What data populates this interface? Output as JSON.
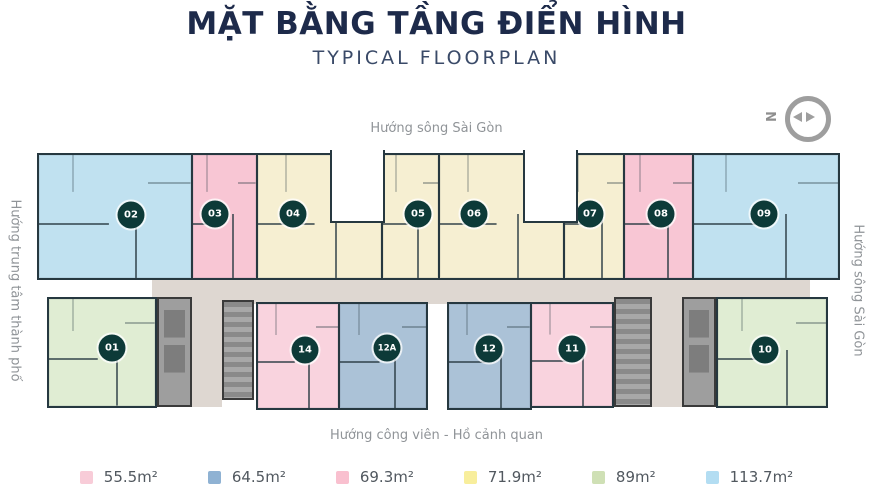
{
  "header": {
    "title": "MẶT BẰNG TẦNG ĐIỂN HÌNH",
    "subtitle": "TYPICAL FLOORPLAN"
  },
  "compass": {
    "north_label": "N"
  },
  "directions": {
    "top": "Hướng sông Sài Gòn",
    "left": "Hướng trung tâm thành phố",
    "right": "Hướng sông Sài Gòn",
    "bottom": "Hướng công viên - Hồ cảnh quan"
  },
  "plan": {
    "units": [
      {
        "id": "02",
        "color": "#c0e1f0",
        "area": "113.7m²"
      },
      {
        "id": "03",
        "color": "#f8c6d4",
        "area": "69.3m²"
      },
      {
        "id": "04",
        "color": "#f6efd2",
        "area": "71.9m²"
      },
      {
        "id": "05",
        "color": "#f6efd2",
        "area": "71.9m²"
      },
      {
        "id": "06",
        "color": "#f6efd2",
        "area": "71.9m²"
      },
      {
        "id": "07",
        "color": "#f6efd2",
        "area": "71.9m²"
      },
      {
        "id": "08",
        "color": "#f8c6d4",
        "area": "69.3m²"
      },
      {
        "id": "09",
        "color": "#c0e1f0",
        "area": "113.7m²"
      },
      {
        "id": "01",
        "color": "#e0edd3",
        "area": "89m²"
      },
      {
        "id": "14",
        "color": "#f9d3de",
        "area": "55.5m²"
      },
      {
        "id": "12A",
        "color": "#abc2d7",
        "area": "64.5m²"
      },
      {
        "id": "12",
        "color": "#abc2d7",
        "area": "64.5m²"
      },
      {
        "id": "11",
        "color": "#f9d3de",
        "area": "55.5m²"
      },
      {
        "id": "10",
        "color": "#e0edd3",
        "area": "89m²"
      }
    ]
  },
  "legend": {
    "items": [
      {
        "label": "55.5m²",
        "color": "#f8ccd8"
      },
      {
        "label": "64.5m²",
        "color": "#8fb2d3"
      },
      {
        "label": "69.3m²",
        "color": "#f9c0cf"
      },
      {
        "label": "71.9m²",
        "color": "#f8ee9c"
      },
      {
        "label": "89m²",
        "color": "#cfe0b5"
      },
      {
        "label": "113.7m²",
        "color": "#b3ddf2"
      }
    ]
  }
}
